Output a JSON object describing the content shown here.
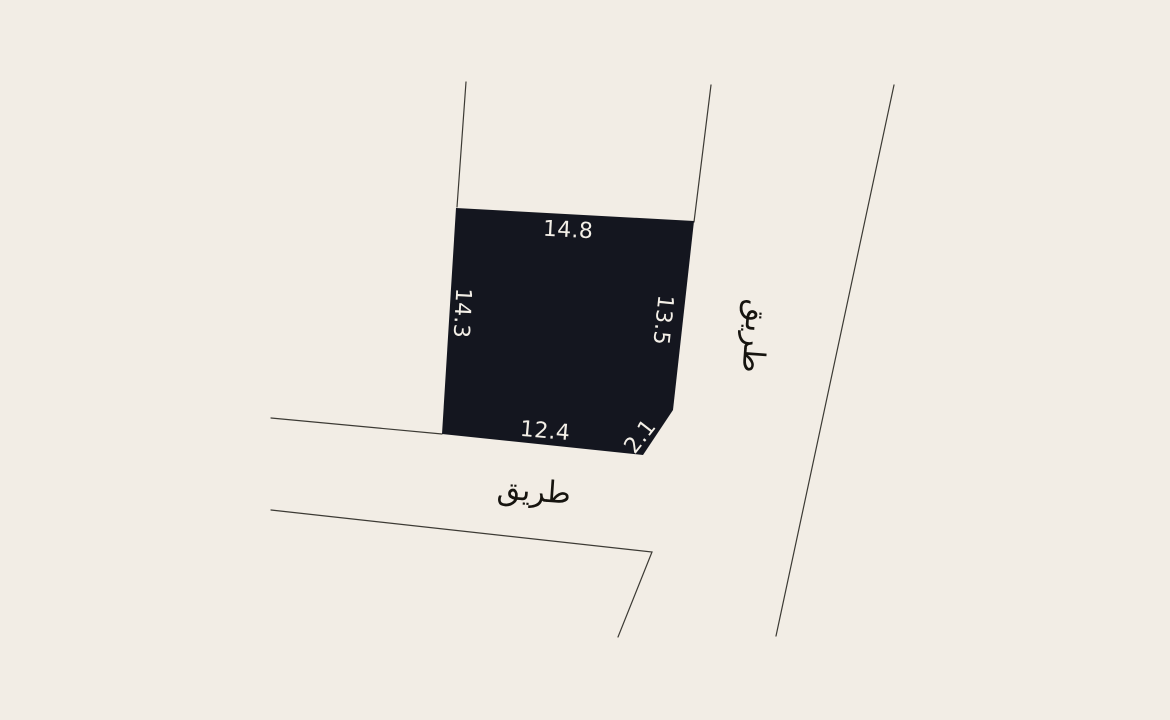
{
  "map": {
    "description_label": "land-plot-sketch",
    "parcel": {
      "dimensions": {
        "top": "14.8",
        "left": "14.3",
        "right": "13.5",
        "bottom": "12.4",
        "corner_cut": "2.1"
      }
    },
    "roads": {
      "right_label": "طريق",
      "bottom_label": "طريق"
    }
  },
  "colors": {
    "background": "#f2ede5",
    "parcel_fill": "#14161f",
    "boundary_line": "#3c3a34",
    "dimension_text": "#f3efe7",
    "road_text": "#16140f"
  }
}
